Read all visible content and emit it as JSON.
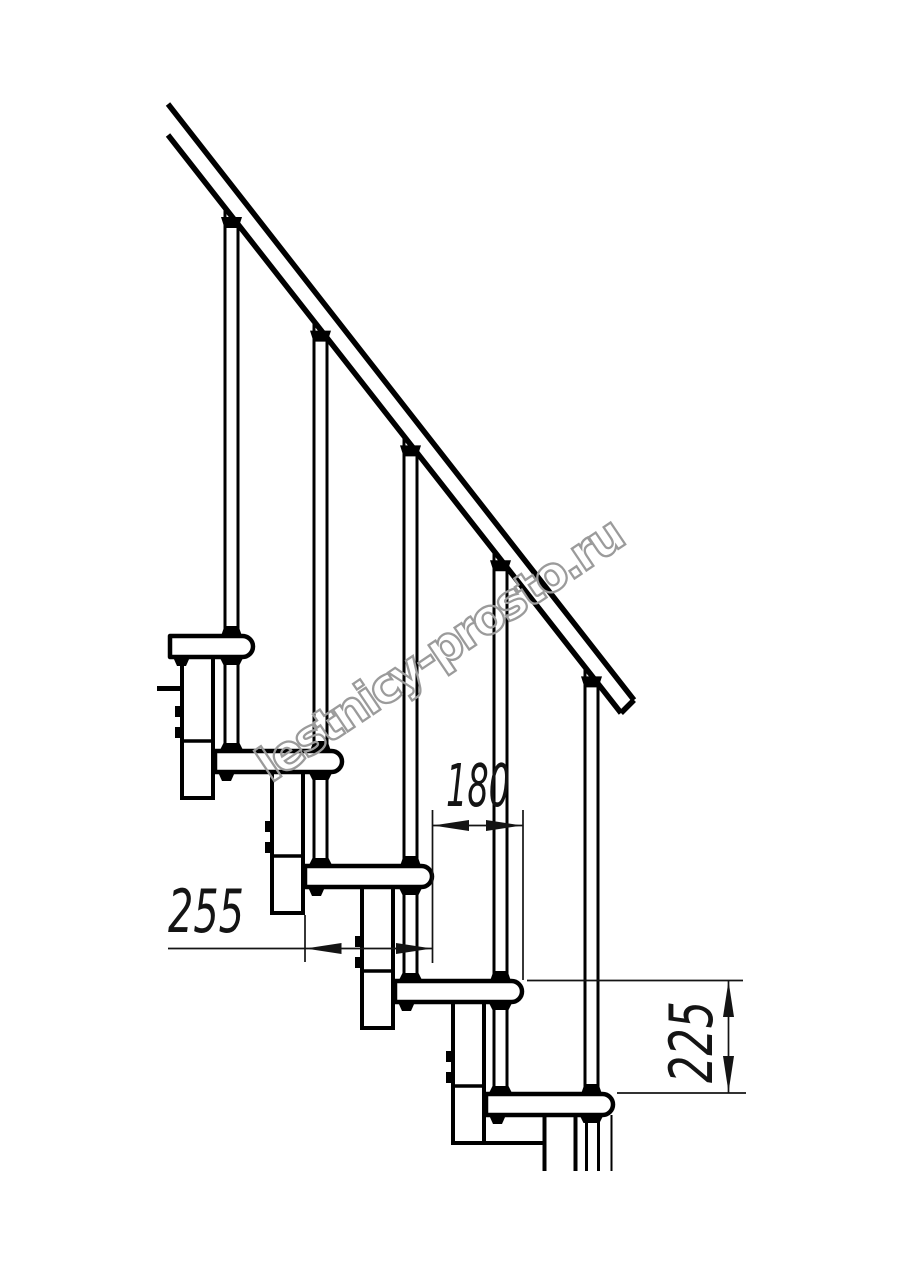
{
  "canvas": {
    "width": 914,
    "height": 1280,
    "background": "#ffffff",
    "line_color": "#000000",
    "dim_color": "#141414"
  },
  "watermark": {
    "text": "lestnicy-prosto.ru",
    "outline_color": "#9b9b9b"
  },
  "drawing": {
    "type": "technical-line-drawing",
    "subject": "modular staircase side elevation with handrail and balusters",
    "units_implied": "mm",
    "tread_count": 5,
    "baluster_count": 5,
    "dimensions": {
      "run": {
        "value": "180",
        "label": "horizontal distance between tread noses"
      },
      "tread_depth": {
        "value": "255",
        "label": "tread depth"
      },
      "rise": {
        "value": "225",
        "label": "vertical rise between treads"
      }
    }
  }
}
